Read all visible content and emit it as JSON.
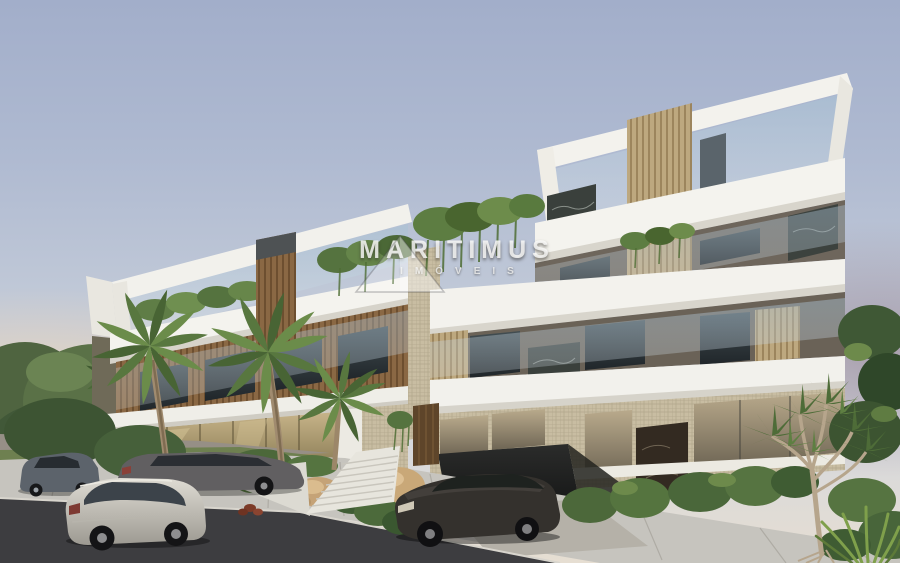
{
  "watermark": {
    "brand": "MARITIMUS",
    "tagline": "IMÓVEIS",
    "logo": "mountain-triangle"
  },
  "scene": {
    "setting": "3D architectural rendering of a modern four-storey apartment building at dusk",
    "objects": [
      "apartment-building",
      "rooftop-pergola-frames",
      "glass-balcony-railings",
      "hanging-gardens",
      "wood-slat-screens",
      "dark-stone-panels",
      "palm-trees",
      "pandanus-tree",
      "entrance-stairs",
      "garage-opening",
      "parked-cars",
      "street",
      "sidewalk"
    ],
    "vehicles": [
      {
        "name": "compact-suv",
        "color": "#5c636b",
        "position": "far-left-street"
      },
      {
        "name": "gray-sedan",
        "color": "#615f61",
        "position": "left-street"
      },
      {
        "name": "silver-suv",
        "color": "#c9c5bb",
        "position": "foreground-left"
      },
      {
        "name": "dark-suv",
        "color": "#34312d",
        "position": "driveway-right"
      }
    ],
    "palette": {
      "sky_top": "#a2aeca",
      "sky_mid": "#c2cad8",
      "sky_horizon_left": "#f4d6b0",
      "sky_horizon_right": "#9e8f9e",
      "facade_white": "#f3f2ed",
      "facade_wood": "#8a6844",
      "facade_tile": "#c8bda2",
      "stone_dark": "#3a403c",
      "glass_blue": "#aac2d4",
      "gold_glass": "#c3b186",
      "foliage_green": "#5d7c42",
      "asphalt": "#3d3d40",
      "sidewalk": "#c6c4be"
    }
  }
}
